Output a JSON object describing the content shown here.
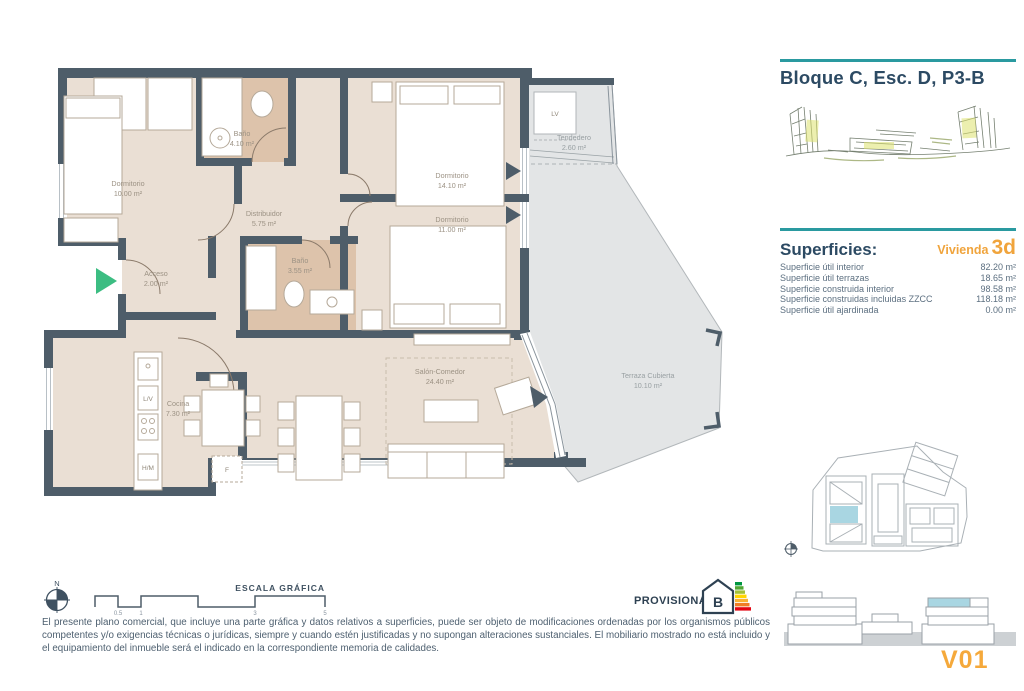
{
  "header": {
    "title": "Bloque C, Esc. D, P3-B"
  },
  "superficies": {
    "heading": "Superficies:",
    "vivienda_label": "Vivienda",
    "vivienda_value": "3d",
    "rows": [
      {
        "label": "Superficie útil interior",
        "value": "82.20 m²"
      },
      {
        "label": "Superficie útil terrazas",
        "value": "18.65 m²"
      },
      {
        "label": "Superficie construida interior",
        "value": "98.58 m²"
      },
      {
        "label": "Superficie construidas incluidas ZZCC",
        "value": "118.18 m²"
      },
      {
        "label": "Superficie útil ajardinada",
        "value": "0.00 m²"
      }
    ]
  },
  "plan": {
    "rooms": [
      {
        "name": "Dormitorio",
        "area": "10.00 m²"
      },
      {
        "name": "Baño",
        "area": "4.10 m²"
      },
      {
        "name": "Dormitorio",
        "area": "14.10 m²"
      },
      {
        "name": "Tendedero",
        "area": "2.60 m²"
      },
      {
        "name": "Distribuidor",
        "area": "5.75 m²"
      },
      {
        "name": "Dormitorio",
        "area": "11.00 m²"
      },
      {
        "name": "Baño",
        "area": "3.55 m²"
      },
      {
        "name": "Acceso",
        "area": "2.00 m²"
      },
      {
        "name": "Cocina",
        "area": "7.30 m²"
      },
      {
        "name": "Salón-Comedor",
        "area": "24.40 m²"
      },
      {
        "name": "Terraza Cubierta",
        "area": "10.10 m²"
      }
    ],
    "labels": {
      "lv": "L/V",
      "hm": "H/M",
      "f": "F",
      "lv_box": "LV"
    }
  },
  "footer": {
    "north_label": "N",
    "scale_label": "ESCALA GRÁFICA",
    "scale_ticks": [
      "0.5",
      "1",
      "3",
      "5"
    ],
    "provisional_label": "PROVISIONAL",
    "energy_letter": "B",
    "disclaimer": "El presente plano comercial, que incluye una parte gráfica y datos relativos a superficies, puede ser objeto de modificaciones ordenadas por los organismos públicos competentes y/o exigencias técnicas o jurídicas, siempre y cuando estén justificadas y no supongan alteraciones sustanciales. El mobiliario mostrado no está incluido y el equipamiento del inmueble será el indicado en la correspondiente memoria de calidades.",
    "version": "V01"
  },
  "colors": {
    "wall": "#4e5d69",
    "floor": "#eadfd4",
    "bath_floor": "#ddc3ab",
    "terrace": "#e3e5e6",
    "accent_teal": "#2a9aa0",
    "accent_orange": "#f0a43c",
    "highlight_unit": "#a9d6e2",
    "entry_arrow": "#3cbd82"
  }
}
